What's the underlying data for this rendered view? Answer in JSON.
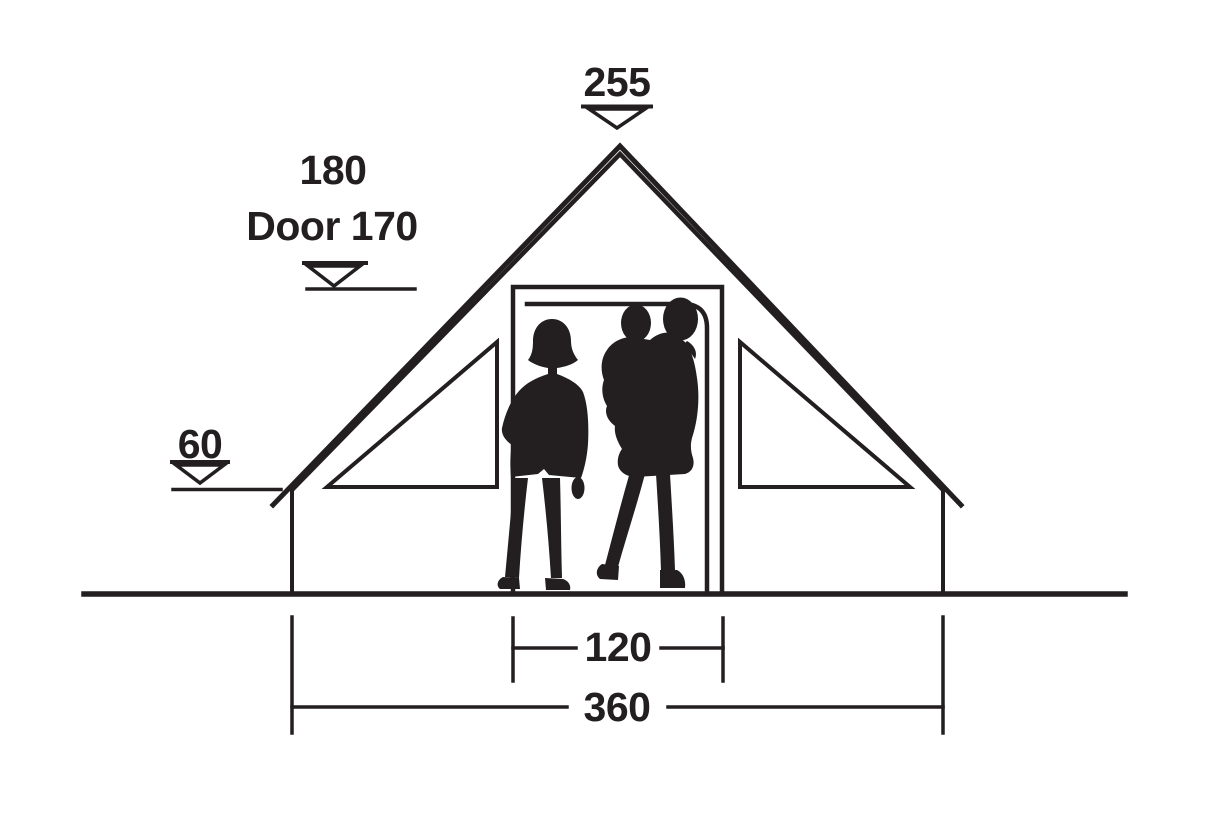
{
  "page": {
    "background": "#ffffff"
  },
  "diagram": {
    "kind": "tent-front-elevation-dimensions",
    "ink_color": "#231f20",
    "labels": {
      "peak_height": "255",
      "interior_height": "180",
      "door_height": "Door 170",
      "side_wall_height": "60",
      "door_width": "120",
      "total_width": "360"
    }
  }
}
